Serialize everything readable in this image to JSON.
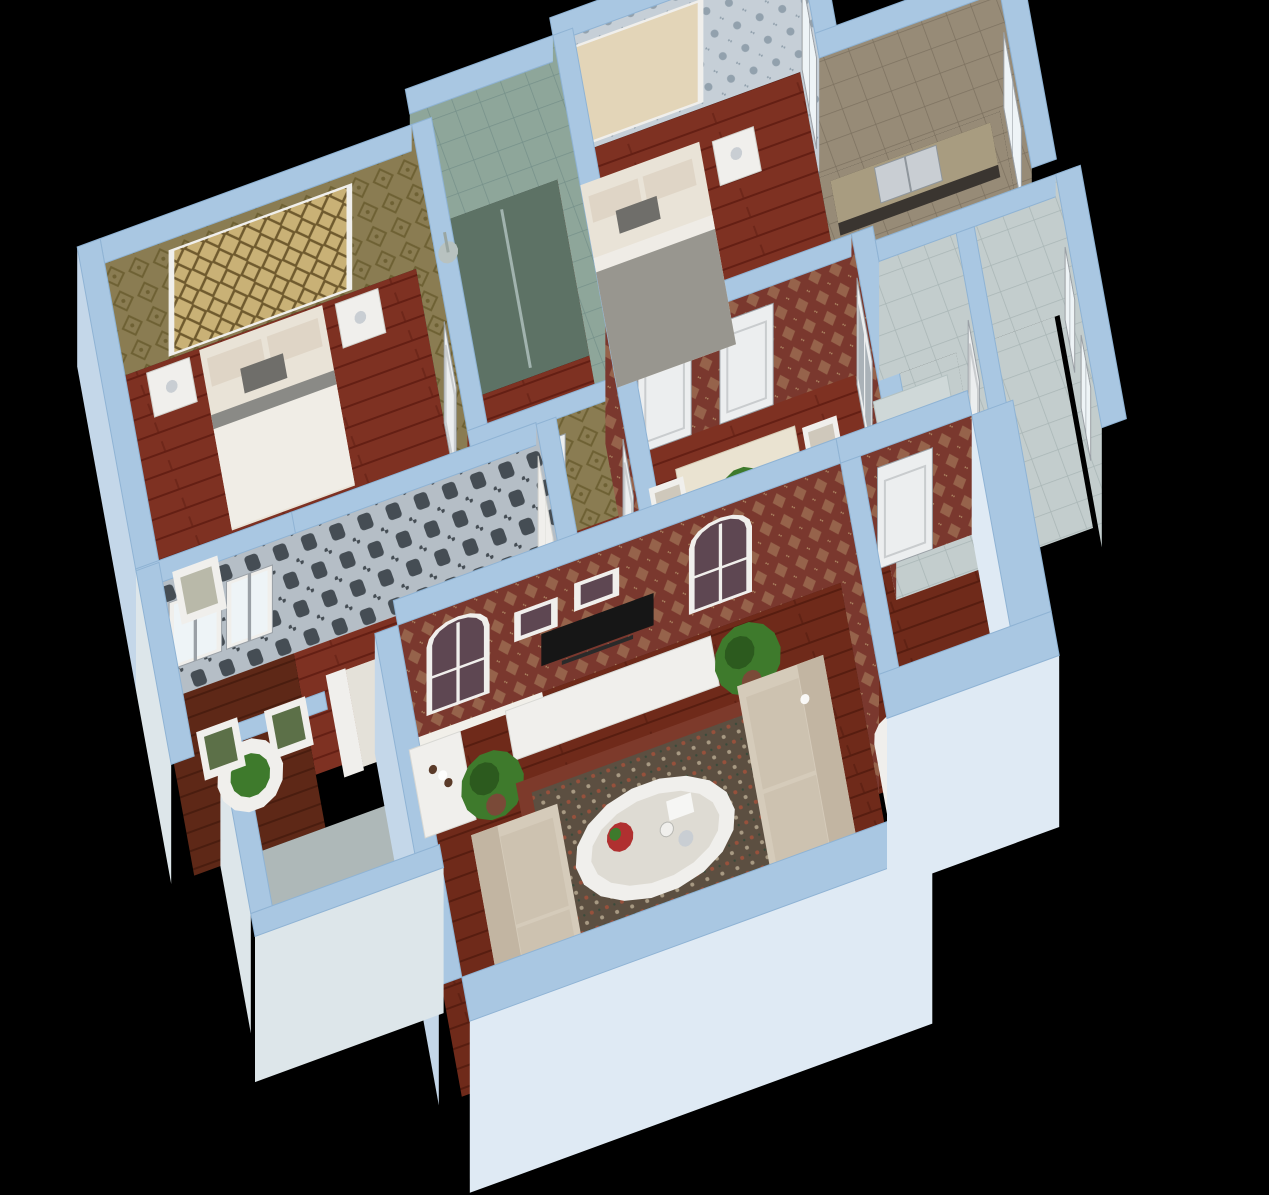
{
  "scene_title": "3d-apartment-floorplan-render",
  "view": "isometric-dollhouse-cutaway",
  "background": "#000000",
  "palette": {
    "wallTop": "#a9c7e2",
    "wallTopEdge": "#8fb3d4",
    "wallOuter": "#c4d7e9",
    "wallOuterBright": "#dfeaf4",
    "woodBase": "#7e3122",
    "woodStripe": "#641f14",
    "woodLBase": "#6f2a1a",
    "woodLStripe": "#571d10",
    "woodBBase": "#5e2817",
    "woodBStripe": "#4a1d0f",
    "olive": "#8a7c52",
    "oliveMotif": "#6e6134",
    "blueDam": "#c6cfd7",
    "blueDamMotif": "#92a1ad",
    "grayDam": "#b5bec6",
    "grayDamMotif": "#454d54",
    "redDam": "#7a382e",
    "redDamMotif": "#ad8662",
    "greenTile": "#8ea69a",
    "greenTileLine": "#76918a",
    "greenFloor": "#5d7265",
    "tanTile": "#978b77",
    "tanTileLine": "#7d7260",
    "lightTile": "#c3cdcd",
    "lightTileLine": "#a9b6b6",
    "lightFloor": "#b7c2c2",
    "white": "#f0efec",
    "offWhite": "#e3e2de",
    "doorWhite": "#eceeef",
    "frameGray": "#9aa0a6",
    "windowPane": "#eef4f7",
    "plum": "#5e4752",
    "goldA": "#c9b176",
    "goldB": "#6f5a2e",
    "creamPanel": "#e3d5b8",
    "bedding": "#e9e3d7",
    "pillow": "#dfd5c6",
    "pillowDark": "#6f6e6a",
    "blanketGray": "#98968f",
    "sofa": "#d5cbba",
    "sofaDark": "#c2b5a2",
    "rugField": "#5c4f41",
    "rugBorder": "#7d3a2b",
    "rugMotif": "#97513c",
    "plant": "#3e7a2c",
    "plantDark": "#2c5a1e",
    "pot": "#7a4a38",
    "tv": "#161616",
    "steel": "#c9ced3",
    "glass": "#dde6ea",
    "marble": "#eae3d1",
    "seatGreen": "#5c7048",
    "counterDark": "#3a3530",
    "counterTop": "#a89c80"
  },
  "rooms": [
    {
      "id": "master-bedroom",
      "wallpaper": "olive",
      "floor": "wood",
      "furniture": [
        "double-bed",
        "nightstand",
        "nightstand",
        "candelabra",
        "armchair",
        "gold-headboard-panel"
      ]
    },
    {
      "id": "ensuite-bathroom",
      "wallpaper": "greenTile",
      "floor": "greenFloor",
      "furniture": [
        "shower-head",
        "glass-partition"
      ]
    },
    {
      "id": "bedroom-2",
      "wallpaper": "blueDam",
      "floor": "wood",
      "furniture": [
        "double-bed",
        "nightstand",
        "candelabra",
        "tufted-headboard-panel",
        "sliding-window"
      ]
    },
    {
      "id": "kitchen",
      "wallpaper": "tanTile",
      "floor": "tanTile",
      "furniture": [
        "counter",
        "double-sink",
        "window"
      ]
    },
    {
      "id": "dining-room",
      "wallpaper": "redDam",
      "floor": "wood",
      "furniture": [
        "dining-table",
        "chair",
        "chair",
        "chair",
        "chair",
        "centerpiece-plant",
        "double-glass-door",
        "white-door",
        "white-door"
      ]
    },
    {
      "id": "bedroom-3",
      "wallpaper": "grayDam",
      "floor": "wood",
      "furniture": [
        "white-bed",
        "wardrobe"
      ]
    },
    {
      "id": "west-balcony",
      "wallpaper": "grayDam",
      "floor": "woodB",
      "furniture": [
        "round-table",
        "potted-plant",
        "chair",
        "chair",
        "glass-wall"
      ]
    },
    {
      "id": "bathroom-a",
      "wallpaper": "lightTile",
      "floor": "lightTile",
      "furniture": [
        "shower-tray",
        "door"
      ]
    },
    {
      "id": "bathroom-b",
      "wallpaper": "lightTile",
      "floor": "lightTile",
      "furniture": [
        "window",
        "door"
      ]
    },
    {
      "id": "living-room",
      "wallpaper": "redDam",
      "floor": "woodL",
      "furniture": [
        "tv",
        "tv-console",
        "wine-shelf",
        "picture-frame",
        "picture-frame",
        "arched-window",
        "arched-window",
        "sofa",
        "sofa",
        "bench",
        "oval-coffee-table",
        "fruit-bowl",
        "tea-set",
        "area-rug",
        "potted-plant",
        "potted-plant",
        "downlight",
        "downlight"
      ]
    },
    {
      "id": "east-hallway",
      "wallpaper": "redDam",
      "floor": "woodL",
      "furniture": [
        "white-door",
        "side-cabinet",
        "arched-column"
      ]
    },
    {
      "id": "sw-balcony",
      "wallpaper": "glass",
      "floor": "lightFloor",
      "furniture": [
        "glass-enclosure"
      ]
    }
  ]
}
